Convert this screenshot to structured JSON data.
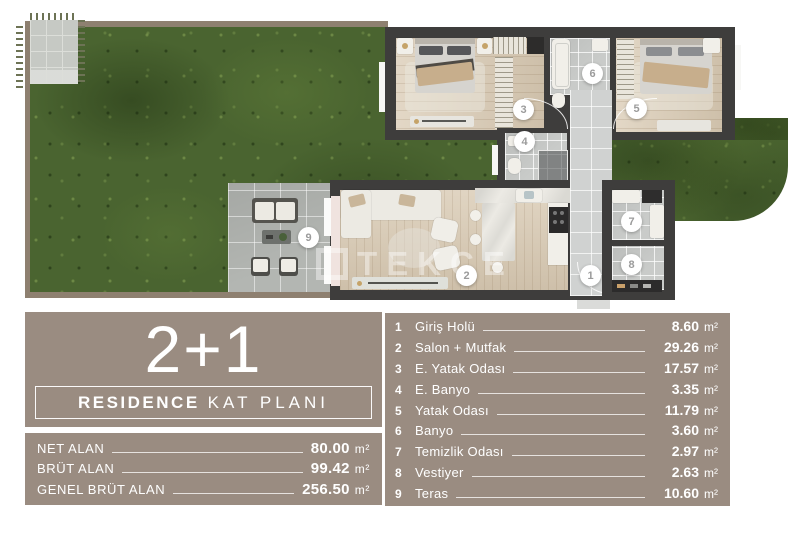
{
  "colors": {
    "panel_bg": "#9a8c81",
    "panel_text": "#ffffff",
    "wall_dark": "#3e3d3c",
    "wall_garden": "#8e8070",
    "grass_base": "#4a6430",
    "wood": "#d9cab3",
    "tile": "#c9cbc9",
    "terrace_tile": "#b3b6b2",
    "marker_text": "#9b9b9b"
  },
  "floor_plan": {
    "watermark": "TEKCE",
    "markers": [
      "1",
      "2",
      "3",
      "4",
      "5",
      "6",
      "7",
      "8",
      "9"
    ]
  },
  "type_panel": {
    "title": "2+1",
    "subtitle_bold": "RESIDENCE",
    "subtitle_light": "KAT PLANI"
  },
  "area_panel": {
    "rows": [
      {
        "label": "NET ALAN",
        "value": "80.00",
        "unit": "m²"
      },
      {
        "label": "BRÜT ALAN",
        "value": "99.42",
        "unit": "m²"
      },
      {
        "label": "GENEL BRÜT ALAN",
        "value": "256.50",
        "unit": "m²"
      }
    ]
  },
  "room_panel": {
    "rows": [
      {
        "num": "1",
        "name": "Giriş Holü",
        "value": "8.60",
        "unit": "m²"
      },
      {
        "num": "2",
        "name": "Salon + Mutfak",
        "value": "29.26",
        "unit": "m²"
      },
      {
        "num": "3",
        "name": "E. Yatak Odası",
        "value": "17.57",
        "unit": "m²"
      },
      {
        "num": "4",
        "name": "E. Banyo",
        "value": "3.35",
        "unit": "m²"
      },
      {
        "num": "5",
        "name": "Yatak Odası",
        "value": "11.79",
        "unit": "m²"
      },
      {
        "num": "6",
        "name": "Banyo",
        "value": "3.60",
        "unit": "m²"
      },
      {
        "num": "7",
        "name": "Temizlik Odası",
        "value": "2.97",
        "unit": "m²"
      },
      {
        "num": "8",
        "name": "Vestiyer",
        "value": "2.63",
        "unit": "m²"
      },
      {
        "num": "9",
        "name": "Teras",
        "value": "10.60",
        "unit": "m²"
      }
    ]
  }
}
